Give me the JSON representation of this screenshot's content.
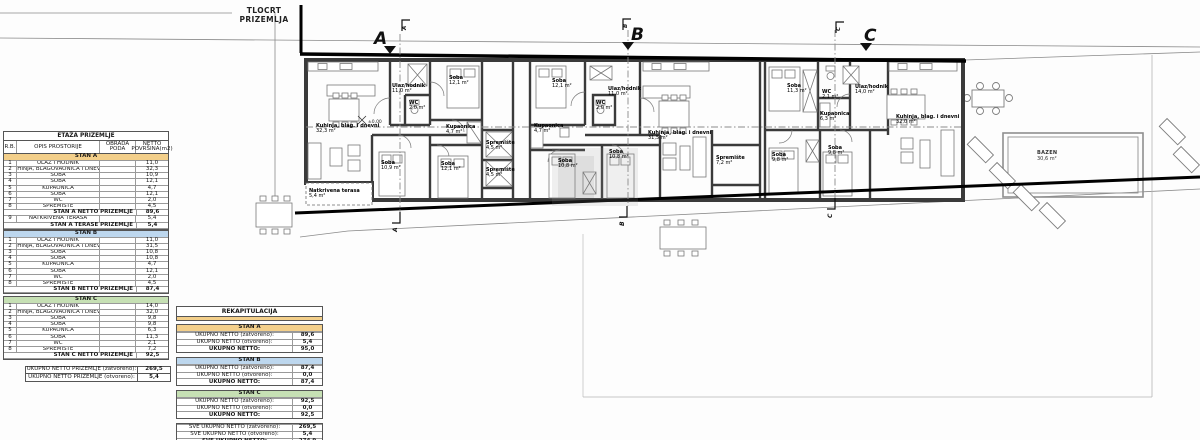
{
  "title": "TLOCRT PRIZEMLJA",
  "markers": {
    "a": "A",
    "b": "B",
    "c": "C"
  },
  "colors": {
    "stan_a": "#f3cf8a",
    "stan_b": "#bdd7ee",
    "stan_c": "#c6e0b4",
    "wall": "#3a3a3a"
  },
  "area_table": {
    "title": "ETAŽA PRIZEMLJE",
    "col_headers": [
      "R.B.",
      "OPIS PROSTORIJE",
      "OBRADA PODA",
      "NETTO POVRŠINA(m2)"
    ],
    "blocks": [
      {
        "header": "STAN A",
        "color": "#f3cf8a",
        "rows": [
          [
            "1",
            "ULAZ I HODNIK",
            "",
            "11,0"
          ],
          [
            "2",
            "KUHINJA, BLAGOVAONICA I DNEVNI",
            "",
            "32,3"
          ],
          [
            "3",
            "SOBA",
            "",
            "10,9"
          ],
          [
            "4",
            "SOBA",
            "",
            "12,1"
          ],
          [
            "5",
            "KUPAONICA",
            "",
            "4,7"
          ],
          [
            "6",
            "SOBA",
            "",
            "12,1"
          ],
          [
            "7",
            "WC",
            "",
            "2,0"
          ],
          [
            "8",
            "SPREMIŠTE",
            "",
            "4,5"
          ]
        ],
        "total": [
          "STAN A NETTO PRIZEMLJE",
          "89,6"
        ],
        "extra_rows": [
          [
            "9",
            "NATKRIVENA TERASA",
            "",
            "5,4"
          ]
        ],
        "extra_total": [
          "STAN A TERASE PRIZEMLJE",
          "5,4"
        ]
      },
      {
        "header": "STAN B",
        "color": "#bdd7ee",
        "rows": [
          [
            "1",
            "ULAZ I HODNIK",
            "",
            "11,0"
          ],
          [
            "2",
            "KUHINJA, BLAGOVAONICA I DNEVNI",
            "",
            "31,5"
          ],
          [
            "3",
            "SOBA",
            "",
            "10,8"
          ],
          [
            "4",
            "SOBA",
            "",
            "10,8"
          ],
          [
            "5",
            "KUPAONICA",
            "",
            "4,7"
          ],
          [
            "6",
            "SOBA",
            "",
            "12,1"
          ],
          [
            "7",
            "WC",
            "",
            "2,0"
          ],
          [
            "8",
            "SPREMIŠTE",
            "",
            "4,5"
          ]
        ],
        "total": [
          "STAN B NETTO PRIZEMLJE",
          "87,4"
        ]
      },
      {
        "header": "STAN C",
        "color": "#c6e0b4",
        "rows": [
          [
            "1",
            "ULAZ I HODNIK",
            "",
            "14,0"
          ],
          [
            "2",
            "KUHINJA, BLAGOVAONICA I DNEVNI",
            "",
            "32,0"
          ],
          [
            "3",
            "SOBA",
            "",
            "9,8"
          ],
          [
            "4",
            "SOBA",
            "",
            "9,8"
          ],
          [
            "5",
            "KUPAONICA",
            "",
            "6,3"
          ],
          [
            "6",
            "SOBA",
            "",
            "11,3"
          ],
          [
            "7",
            "WC",
            "",
            "2,1"
          ],
          [
            "8",
            "SPREMIŠTE",
            "",
            "7,2"
          ]
        ],
        "total": [
          "STAN C NETTO PRIZEMLJE",
          "92,5"
        ]
      }
    ],
    "grand": [
      [
        "UKUPNO NETTO PRIZEMLJE (zatvoreno):",
        "269,5"
      ],
      [
        "UKUPNO NETTO PRIZEMLJE (otvoreno):",
        "5,4"
      ]
    ]
  },
  "rekap": {
    "title": "REKAPITULACIJA",
    "blocks": [
      {
        "header": "STAN A",
        "color": "#f3cf8a",
        "rows": [
          [
            "UKUPNO NETTO  (zatvoreno):",
            "89,6"
          ],
          [
            "UKUPNO NETTO  (otvoreno):",
            "5,4"
          ],
          [
            "UKUPNO NETTO:",
            "95,0"
          ]
        ]
      },
      {
        "header": "STAN B",
        "color": "#bdd7ee",
        "rows": [
          [
            "UKUPNO NETTO  (zatvoreno):",
            "87,4"
          ],
          [
            "UKUPNO NETTO  (otvoreno):",
            "0,0"
          ],
          [
            "UKUPNO NETTO:",
            "87,4"
          ]
        ]
      },
      {
        "header": "STAN C",
        "color": "#c6e0b4",
        "rows": [
          [
            "UKUPNO NETTO  (zatvoreno):",
            "92,5"
          ],
          [
            "UKUPNO NETTO  (otvoreno):",
            "0,0"
          ],
          [
            "UKUPNO NETTO:",
            "92,5"
          ]
        ]
      }
    ],
    "grand": [
      [
        "SVE UKUPNO NETTO  (zatvoreno):",
        "269,5"
      ],
      [
        "SVE UKUPNO NETTO  (otvoreno):",
        "5,4"
      ],
      [
        "SVE UKUPNO NETTO:",
        "274,9"
      ]
    ]
  },
  "floor_plan": {
    "level_mark": "±0,00",
    "pool": {
      "name": "BAZEN",
      "area": "30,6 m²"
    },
    "rooms": [
      {
        "name": "Kuhinja, blag. i dnevni",
        "area": "32,3 m²",
        "x": 316,
        "y": 124
      },
      {
        "name": "Ulaz/hodnik",
        "area": "11,0 m²",
        "x": 392,
        "y": 84
      },
      {
        "name": "WC",
        "area": "2,0 m²",
        "x": 409,
        "y": 101
      },
      {
        "name": "Soba",
        "area": "12,1 m²",
        "x": 449,
        "y": 76
      },
      {
        "name": "Kupaonica",
        "area": "4,7 m²",
        "x": 446,
        "y": 125
      },
      {
        "name": "Soba",
        "area": "10,9 m²",
        "x": 381,
        "y": 161
      },
      {
        "name": "Soba",
        "area": "12,1 m²",
        "x": 441,
        "y": 162
      },
      {
        "name": "Spremište",
        "area": "4,5 m²",
        "x": 486,
        "y": 141
      },
      {
        "name": "Spremište",
        "area": "4,5 m²",
        "x": 486,
        "y": 168
      },
      {
        "name": "Natkrivena terasa",
        "area": "5,4 m²",
        "x": 309,
        "y": 189
      },
      {
        "name": "Soba",
        "area": "12,1 m²",
        "x": 552,
        "y": 79
      },
      {
        "name": "Ulaz/hodnik",
        "area": "11,0 m²",
        "x": 608,
        "y": 87
      },
      {
        "name": "WC",
        "area": "2,0 m²",
        "x": 596,
        "y": 101
      },
      {
        "name": "Kupaonica",
        "area": "4,7 m²",
        "x": 534,
        "y": 124
      },
      {
        "name": "Soba",
        "area": "10,8 m²",
        "x": 558,
        "y": 159
      },
      {
        "name": "Soba",
        "area": "10,8 m²",
        "x": 609,
        "y": 150
      },
      {
        "name": "Kuhinja, blag. i dnevni",
        "area": "31,5 m²",
        "x": 648,
        "y": 131
      },
      {
        "name": "Spremište",
        "area": "7,2 m²",
        "x": 716,
        "y": 156
      },
      {
        "name": "Soba",
        "area": "11,3 m²",
        "x": 787,
        "y": 84
      },
      {
        "name": "WC",
        "area": "2,1 m²",
        "x": 822,
        "y": 90
      },
      {
        "name": "Kupaonica",
        "area": "6,3 m²",
        "x": 820,
        "y": 112
      },
      {
        "name": "Ulaz/hodnik",
        "area": "14,0 m²",
        "x": 855,
        "y": 85
      },
      {
        "name": "Kuhinja, blag. i dnevni",
        "area": "32,0 m²",
        "x": 896,
        "y": 115
      },
      {
        "name": "Soba",
        "area": "9,8 m²",
        "x": 772,
        "y": 153
      },
      {
        "name": "Soba",
        "area": "9,8 m²",
        "x": 828,
        "y": 146
      }
    ]
  }
}
